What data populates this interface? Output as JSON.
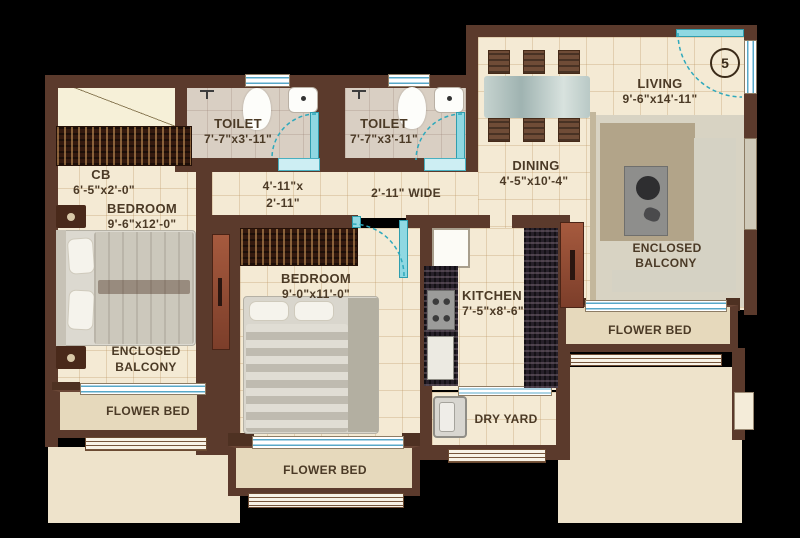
{
  "plan": {
    "unit_number": "5",
    "rooms": {
      "toilet1": {
        "name": "TOILET",
        "dims": "7'-7\"x3'-11\""
      },
      "toilet2": {
        "name": "TOILET",
        "dims": "7'-7\"x3'-11\""
      },
      "cb": {
        "name": "CB",
        "dims": "6'-5\"x2'-0\""
      },
      "bedroom1": {
        "name": "BEDROOM",
        "dims": "9'-6\"x12'-0\""
      },
      "bedroom2": {
        "name": "BEDROOM",
        "dims": "9'-0\"x11'-0\""
      },
      "kitchen": {
        "name": "KITCHEN",
        "dims": "7'-5\"x8'-6\""
      },
      "dining": {
        "name": "DINING",
        "dims": "4'-5\"x10'-4\""
      },
      "living": {
        "name": "LIVING",
        "dims": "9'-6\"x14'-11\""
      },
      "balcony_left": {
        "line1": "ENCLOSED",
        "line2": "BALCONY"
      },
      "balcony_right": {
        "line1": "ENCLOSED",
        "line2": "BALCONY"
      },
      "flower_bed_left": {
        "name": "FLOWER BED"
      },
      "flower_bed_bottom": {
        "name": "FLOWER BED"
      },
      "flower_bed_right": {
        "name": "FLOWER BED"
      },
      "dry_yard": {
        "name": "DRY YARD"
      }
    },
    "passages": {
      "lobby": {
        "line1": "4'-11\"x",
        "line2": "2'-11\""
      },
      "corridor": {
        "width_label": "2'-11\" WIDE"
      }
    },
    "colors": {
      "wall": "#5b3a2c",
      "floor": "#f4ead4",
      "door_accent": "#49b8c8",
      "text": "#4b3a26"
    }
  }
}
